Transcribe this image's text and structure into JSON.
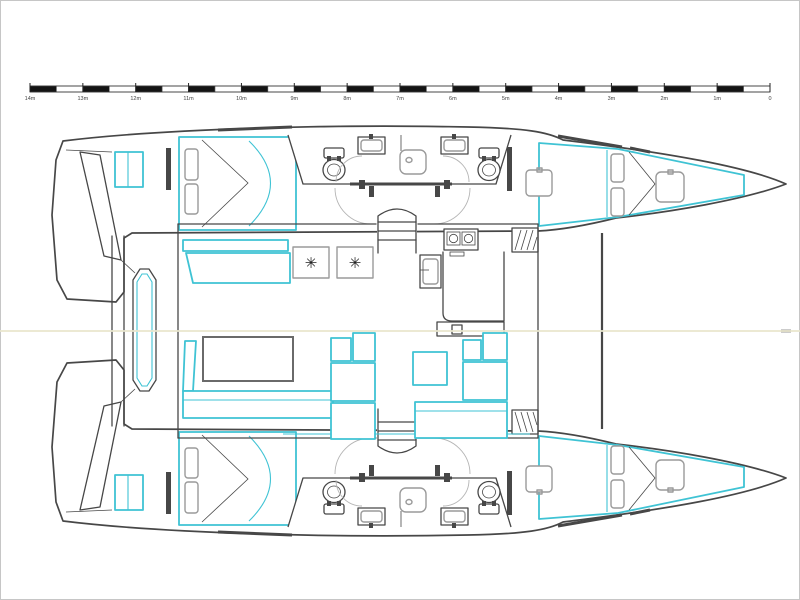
{
  "window": {
    "background": "#ffffff",
    "border_color": "#c6c6c6"
  },
  "scale_bar": {
    "labels": [
      "14m",
      "13m",
      "12m",
      "11m",
      "10m",
      "9m",
      "8m",
      "7m",
      "6m",
      "5m",
      "4m",
      "3m",
      "2m",
      "1m",
      "0"
    ],
    "bar_color": "#141414",
    "label_color": "#444444",
    "meters_total": 14
  },
  "plan": {
    "outline_color": "#474747",
    "accent_color": "#3fc3d4",
    "furniture_color": "#9a9a9a",
    "centerline_color": "#e9e6cd",
    "fridge_icon": "✳"
  }
}
